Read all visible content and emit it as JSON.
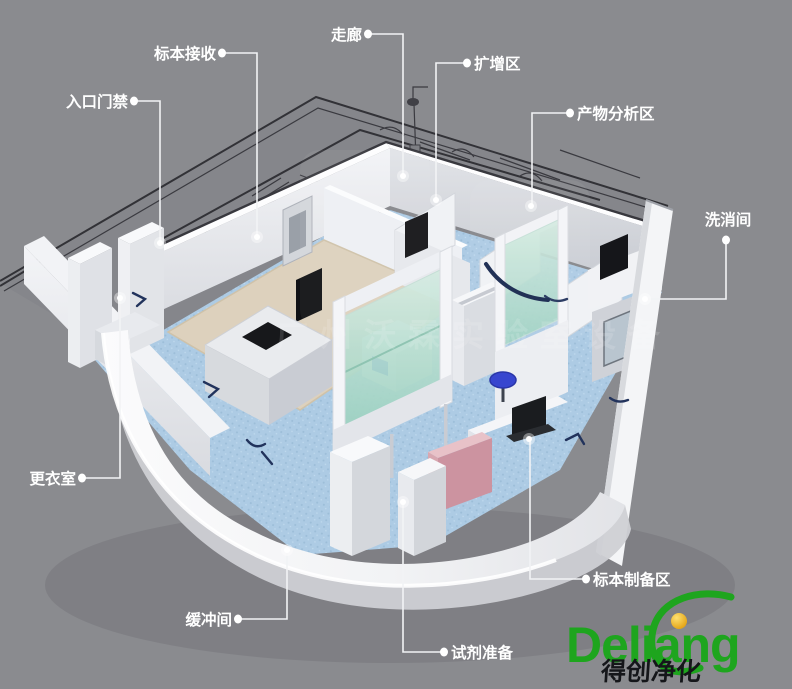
{
  "colors": {
    "background": "#8a8b8f",
    "label_text": "#ffffff",
    "leader_line": "#f2f3f5",
    "floor_blue": "#adcbe4",
    "floor_tan": "#ddd1bd",
    "wall_white": "#f5f6f8",
    "glass_teal": "#b7ddd0",
    "stool_blue": "#3746cf",
    "logo_green": "#1ea51e",
    "logo_gold": "#f0ac00",
    "logo_black": "#15161a"
  },
  "labels": [
    {
      "id": "biaoben-jieshou",
      "text": "标本接收",
      "anchor": "end",
      "tx": 216,
      "ty": 59,
      "dot": [
        222,
        53
      ],
      "path": "M222,53 H257 V237",
      "end": [
        257,
        237
      ]
    },
    {
      "id": "rukou-menjin",
      "text": "入口门禁",
      "anchor": "end",
      "tx": 128,
      "ty": 107,
      "dot": [
        134,
        101
      ],
      "path": "M134,101 H160 V243",
      "end": [
        160,
        243
      ]
    },
    {
      "id": "zoulang",
      "text": "走廊",
      "anchor": "end",
      "tx": 362,
      "ty": 40,
      "dot": [
        368,
        34
      ],
      "path": "M368,34 H403 V176",
      "end": [
        403,
        176
      ]
    },
    {
      "id": "kuozengqu",
      "text": "扩增区",
      "anchor": "start",
      "tx": 474,
      "ty": 69,
      "dot": [
        467,
        63
      ],
      "path": "M467,63 H436 V200",
      "end": [
        436,
        200
      ]
    },
    {
      "id": "chanwu-fenxiqu",
      "text": "产物分析区",
      "anchor": "start",
      "tx": 577,
      "ty": 119,
      "dot": [
        570,
        113
      ],
      "path": "M570,113 H532 V206",
      "end": [
        531,
        206
      ]
    },
    {
      "id": "xixiaojian",
      "text": "洗消间",
      "anchor": "middle",
      "tx": 728,
      "ty": 225,
      "dot": [
        726,
        240
      ],
      "path": "M726,240 V299 H645",
      "end": [
        645,
        299
      ]
    },
    {
      "id": "gengyishi",
      "text": "更衣室",
      "anchor": "end",
      "tx": 76,
      "ty": 484,
      "dot": [
        82,
        478
      ],
      "path": "M82,478 H120 V298",
      "end": [
        120,
        298
      ]
    },
    {
      "id": "huanchongjian",
      "text": "缓冲间",
      "anchor": "end",
      "tx": 232,
      "ty": 625,
      "dot": [
        238,
        619
      ],
      "path": "M238,619 H287 V550",
      "end": [
        287,
        550
      ]
    },
    {
      "id": "shiji-zhunbei",
      "text": "试剂准备",
      "anchor": "start",
      "tx": 451,
      "ty": 658,
      "dot": [
        444,
        652
      ],
      "path": "M444,652 H403 V502",
      "end": [
        403,
        502
      ]
    },
    {
      "id": "biaoben-zhibeiqu",
      "text": "标本制备区",
      "anchor": "start",
      "tx": 593,
      "ty": 585,
      "dot": [
        586,
        579
      ],
      "path": "M586,579 H530 V439",
      "end": [
        529,
        439
      ]
    }
  ],
  "watermark": {
    "text": "广州沃霖实验室设备"
  },
  "logo": {
    "brand": "Deliang",
    "tagline": "得创净化"
  }
}
